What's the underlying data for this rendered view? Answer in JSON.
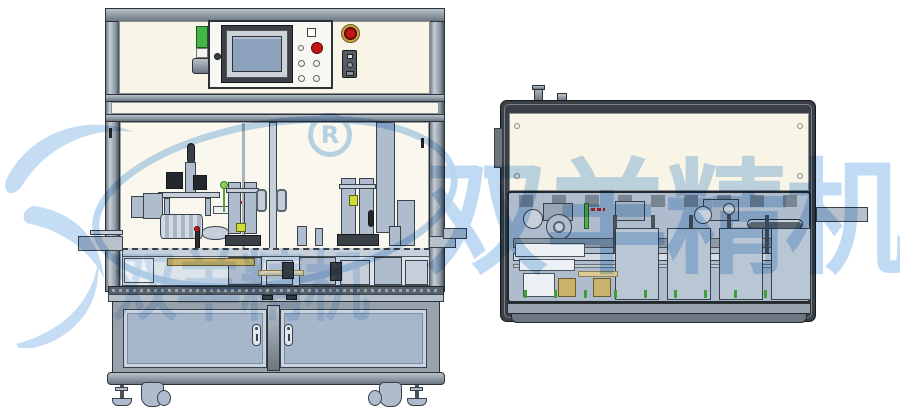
{
  "watermark": {
    "cn_text": "双羊精机",
    "registered_symbol": "R",
    "color": "#b9d6f1",
    "logo": "swoosh-logo"
  },
  "palette": {
    "frame_gray": "#8e99a4",
    "panel_cream": "#f8f5e7",
    "part_blue_gray": "#aebccd",
    "door_blue": "#a7b7cb",
    "dark_outline": "#2c3237",
    "estop_red": "#c41414",
    "tower_light_green": "#44b348",
    "hmi_screen_blue": "#8ca1bc",
    "brass_gold": "#cbb26b",
    "lime_marker": "#cddc39",
    "watermark_blue": "#b9d6f1"
  },
  "machines": {
    "left_view": "automatic-assembly-machine-front-view",
    "right_view": "assembly-module-side-view"
  }
}
